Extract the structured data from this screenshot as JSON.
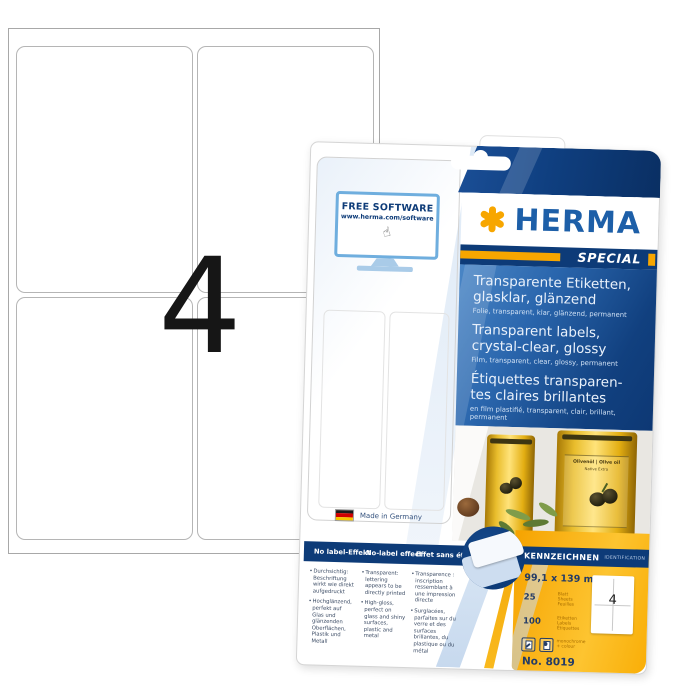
{
  "product_shot": {
    "sheet_count": "4",
    "free_software": {
      "title": "FREE SOFTWARE",
      "url": "www.herma.com/software"
    },
    "brand": {
      "name": "HERMA",
      "special": "SPECIAL"
    },
    "descriptions": [
      {
        "title_lines": [
          "Transparente Etiketten,",
          "glasklar, glänzend"
        ],
        "subtitle": "Folie, transparent, klar, glänzend, permanent"
      },
      {
        "title_lines": [
          "Transparent labels,",
          "crystal-clear, glossy"
        ],
        "subtitle": "Film, transparent, clear, glossy, permanent"
      },
      {
        "title_lines": [
          "Étiquettes transparen-",
          "tes claires brillantes"
        ],
        "subtitle": "en film plastifié, transparent, clair, brillant, permanent"
      }
    ],
    "photo": {
      "bottle_label_title": "Olivenöl | Olive oil",
      "bottle_label_sub": "Native Extra"
    },
    "made_in": "Made in Germany",
    "features": {
      "columns": [
        {
          "header": "No label-Effekt",
          "bullets": [
            "Durchsichtig: Beschriftung wirkt wie direkt aufgedruckt",
            "Hochglänzend, perfekt auf Glas und glänzenden Oberflächen, Plastik und Metall"
          ]
        },
        {
          "header": "No-label effect",
          "bullets": [
            "Transparent: lettering appears to be directly printed",
            "High-gloss, perfect on glass and shiny surfaces, plastic and metal"
          ]
        },
        {
          "header": "Effet sans étiquette",
          "bullets": [
            "Transparence : inscription ressemblant à une impression directe",
            "Surglacées, parfaites sur du verre et des surfaces brillantes, du plastique ou du métal"
          ]
        }
      ]
    },
    "spec_panel": {
      "header": "KENNZEICHNEN",
      "header_sub": "IDENTIFICATION",
      "size": "99,1 x 139 mm",
      "sheets_count": "25",
      "sheets_units": [
        "Blatt",
        "Sheets",
        "Feuilles"
      ],
      "labels_count": "100",
      "labels_units": [
        "Etiketten",
        "Labels",
        "Étiquettes"
      ],
      "print_note_lines": [
        "monochrome",
        "+ colour"
      ],
      "product_no": "No. 8019",
      "mini_sheet_count": "4"
    }
  },
  "icons": {
    "hand": "☝"
  },
  "colors": {
    "herma_blue": "#1d5fa8",
    "navy": "#0d3b78",
    "accent_orange": "#f7a600",
    "panel_orange": "#f9ab00",
    "photo_bg": "#e9e7e2"
  }
}
